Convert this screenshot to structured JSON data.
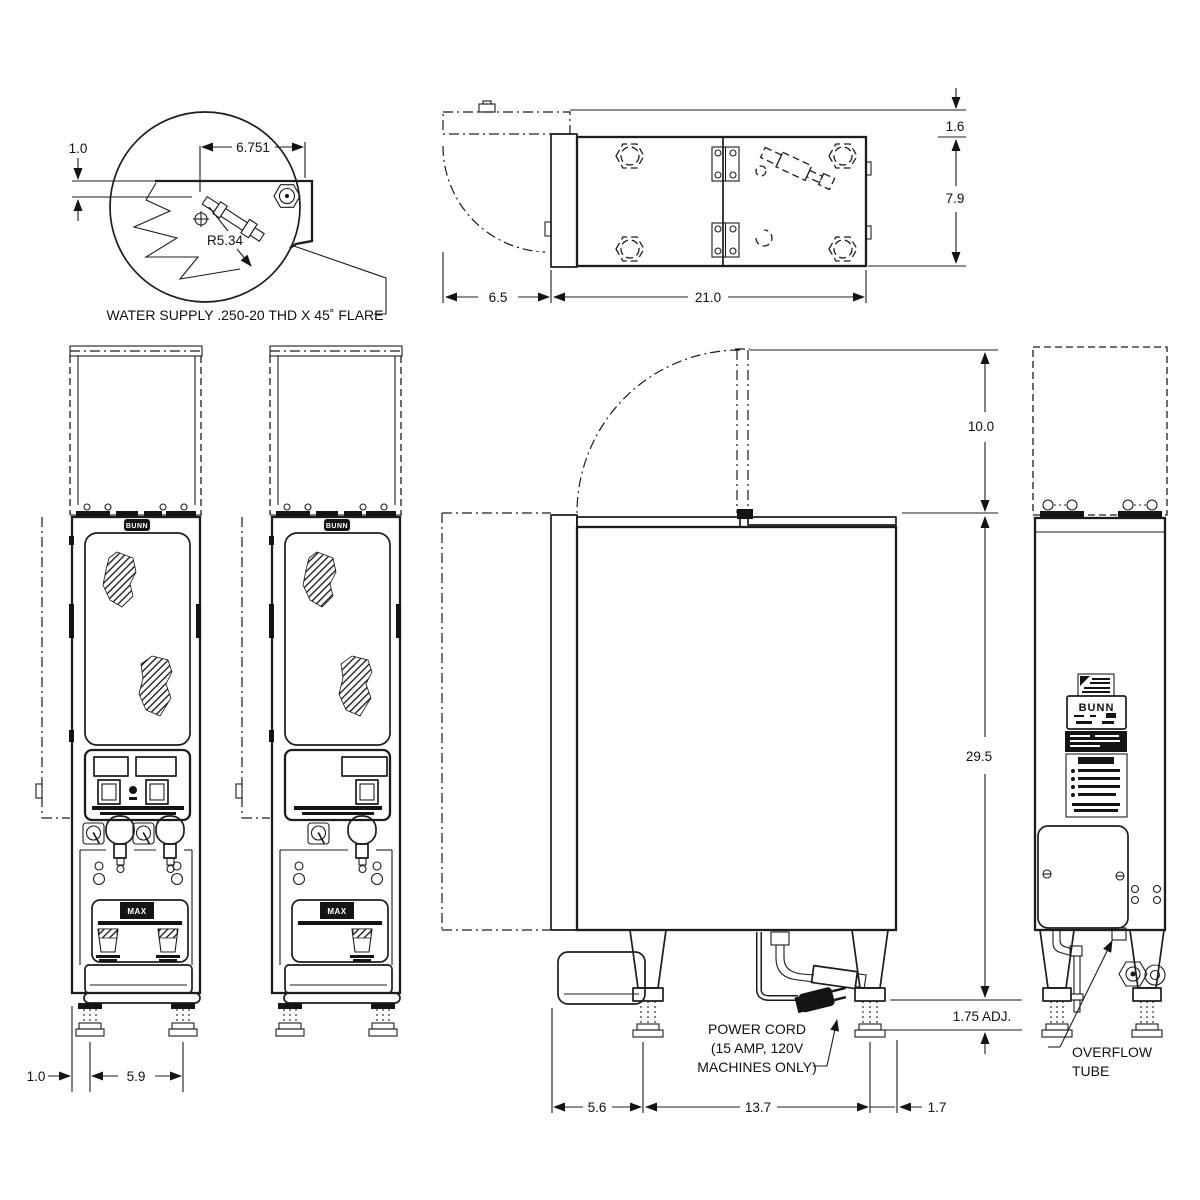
{
  "detail_view": {
    "dim_offset": "1.0",
    "dim_width": "6.751",
    "dim_radius": "R5.34",
    "callout": "WATER SUPPLY .250-20 THD X 45˚ FLARE"
  },
  "top_view": {
    "dim_lid_gap": "1.6",
    "dim_depth": "7.9",
    "dim_door_depth": "6.5",
    "dim_body_width": "21.0"
  },
  "front_views": {
    "dim_left_offset": "1.0",
    "dim_leg_spacing": "5.9",
    "badge": "BUNN",
    "decal": "MAX"
  },
  "side_view": {
    "dim_lid_open": "10.0",
    "dim_body_height": "29.5",
    "dim_leg_adjust": "1.75 ADJ.",
    "dim_front_inset": "5.6",
    "dim_leg_span": "13.7",
    "dim_rear_inset": "1.7",
    "power_cord_note": [
      "POWER CORD",
      "(15 AMP, 120V",
      "MACHINES ONLY)"
    ]
  },
  "rear_view": {
    "brand": "BUNN",
    "overflow_note": [
      "OVERFLOW",
      "TUBE"
    ]
  }
}
